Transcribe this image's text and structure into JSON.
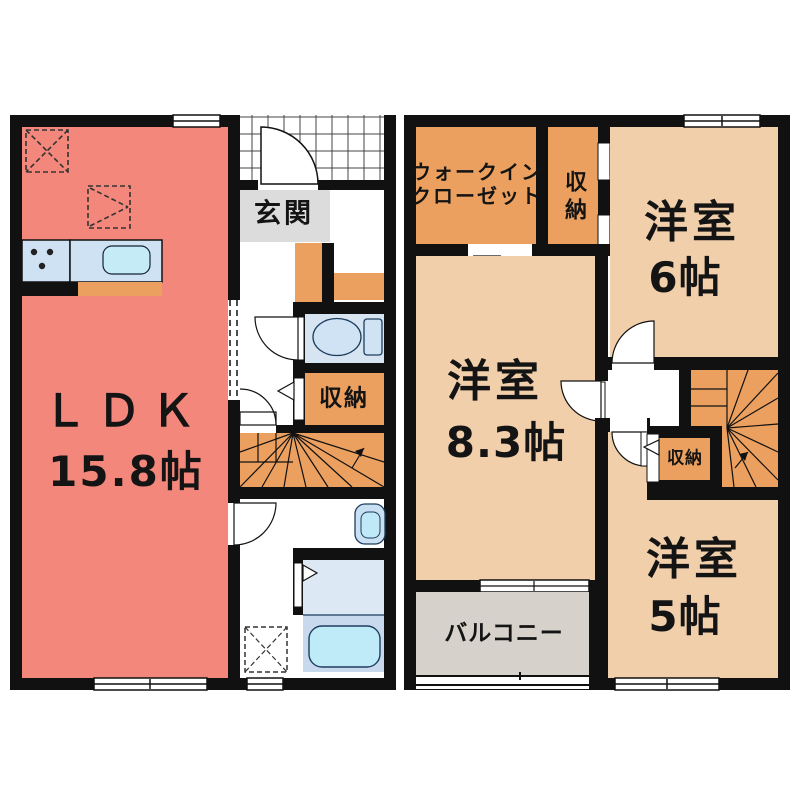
{
  "document_type": "apartment floor plan (two floors, Japanese)",
  "floor1": {
    "ldk_name": "ＬＤＫ",
    "ldk_size": "15.8帖",
    "genkan_label": "玄関",
    "storage_label": "収納",
    "fixtures": [
      "kitchen-counter",
      "stove-burners",
      "kitchen-sink",
      "refrigerator-space-dashed",
      "toilet",
      "washbasin",
      "washing-machine-space-dashed",
      "bathtub",
      "staircase"
    ]
  },
  "floor2": {
    "walk_in_closet_line1": "ウォークイン",
    "walk_in_closet_line2": "クローゼット",
    "closet_top_label": "収納",
    "room6_name": "洋室",
    "room6_size": "6帖",
    "room83_name": "洋室",
    "room83_size": "8.3帖",
    "room5_name": "洋室",
    "room5_size": "5帖",
    "closet_small_label": "収納",
    "balcony_label": "バルコニー",
    "fixtures": [
      "staircase",
      "hinged-doors",
      "folding-closet-doors",
      "balcony-sliding-window"
    ]
  },
  "colors": {
    "wall": "#111111",
    "ldk_fill": "#f4877c",
    "western_room_fill": "#f2cfab",
    "storage_stairs_fill": "#eba05f",
    "genkan_fill": "#dcdcdc",
    "balcony_fill": "#d6d2cb",
    "toilet_room_fill": "#d7e5f3",
    "bath_upper_fill": "#dce9f5",
    "bath_lower_fill": "#c9d9ed",
    "bathtub_fill": "#bfeaf8",
    "counter_fill": "#cfe2f4",
    "sink_inner_fill": "#c5ebf7",
    "background": "#ffffff"
  }
}
